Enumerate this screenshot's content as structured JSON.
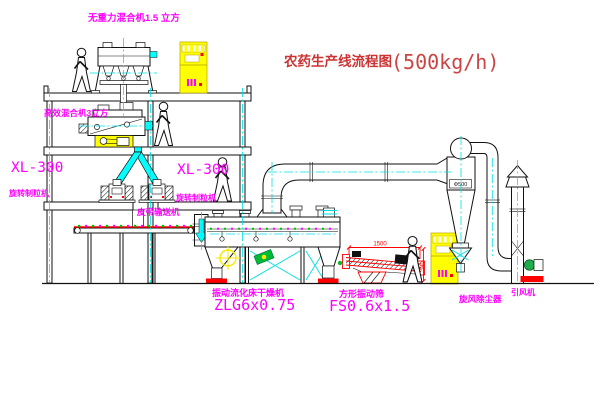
{
  "title": {
    "text": "农药生产线流程图",
    "capacity": "(500kg/h)"
  },
  "colors": {
    "label_magenta": "#ff00ff",
    "title_red": "#cc3333",
    "dimension_red": "#ff0000",
    "highlight_yellow": "#ffff00",
    "centerline_cyan": "#00e0e0",
    "line_black": "#111111",
    "accent_green": "#00bb33"
  },
  "equipment": {
    "top_mixer": {
      "label": "无重力混合机1.5 立方"
    },
    "mid_mixer": {
      "label": "高效混合机3立方"
    },
    "granulator_left": {
      "model": "XL-300",
      "name": "旋转制粒机"
    },
    "granulator_center": {
      "model": "XL-300",
      "name": "旋转制粒机"
    },
    "belt_conveyor": {
      "label": "皮带输送机"
    },
    "dryer": {
      "name": "振动流化床干燥机",
      "model": "ZLG6x0.75"
    },
    "sieve": {
      "name": "方形振动筛",
      "model": "FS0.6x1.5"
    },
    "cyclone": {
      "name": "旋风除尘器",
      "size": "Φ500"
    },
    "fan": {
      "name": "引风机"
    }
  },
  "dimensions": {
    "sieve_length": "1500",
    "sieve_height": "540"
  }
}
